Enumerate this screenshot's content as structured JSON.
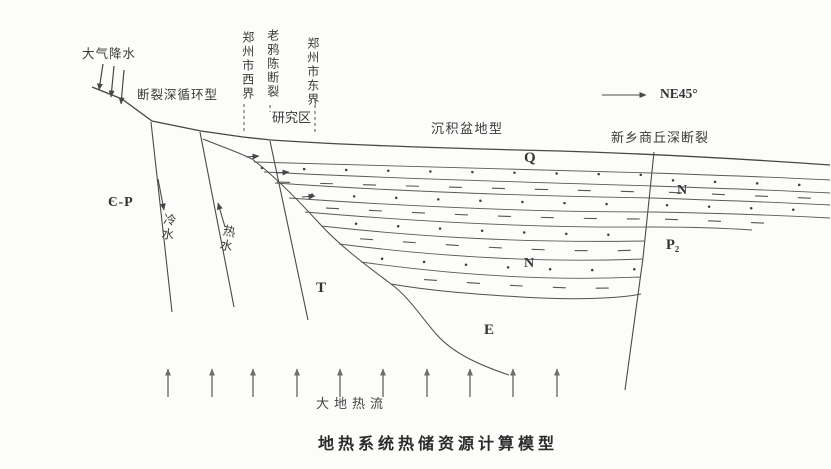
{
  "caption": "地热系统热储资源计算模型",
  "top": {
    "precipitation": "大气降水",
    "fault_circulation_type": "断裂深循环型",
    "west_boundary": "郑州市西界",
    "laoyachen_fault": "老鸦陈断裂",
    "study_area": "研究区",
    "east_boundary": "郑州市东界",
    "basin_type": "沉积盆地型",
    "xinxiang_shangqiu_fault": "新乡商丘深断裂",
    "direction": "NE45°"
  },
  "units": {
    "q": "Q",
    "n_upper": "N",
    "n_lower": "N",
    "p2": "P₂",
    "t": "T",
    "e": "E",
    "cambrian_permian": "Є-P"
  },
  "flows": {
    "cold_water": "冷水",
    "hot_water": "热水",
    "heat_flow": "大地热流"
  },
  "colors": {
    "ink": "#3f3f3f",
    "paper": "#fcfcfa"
  }
}
